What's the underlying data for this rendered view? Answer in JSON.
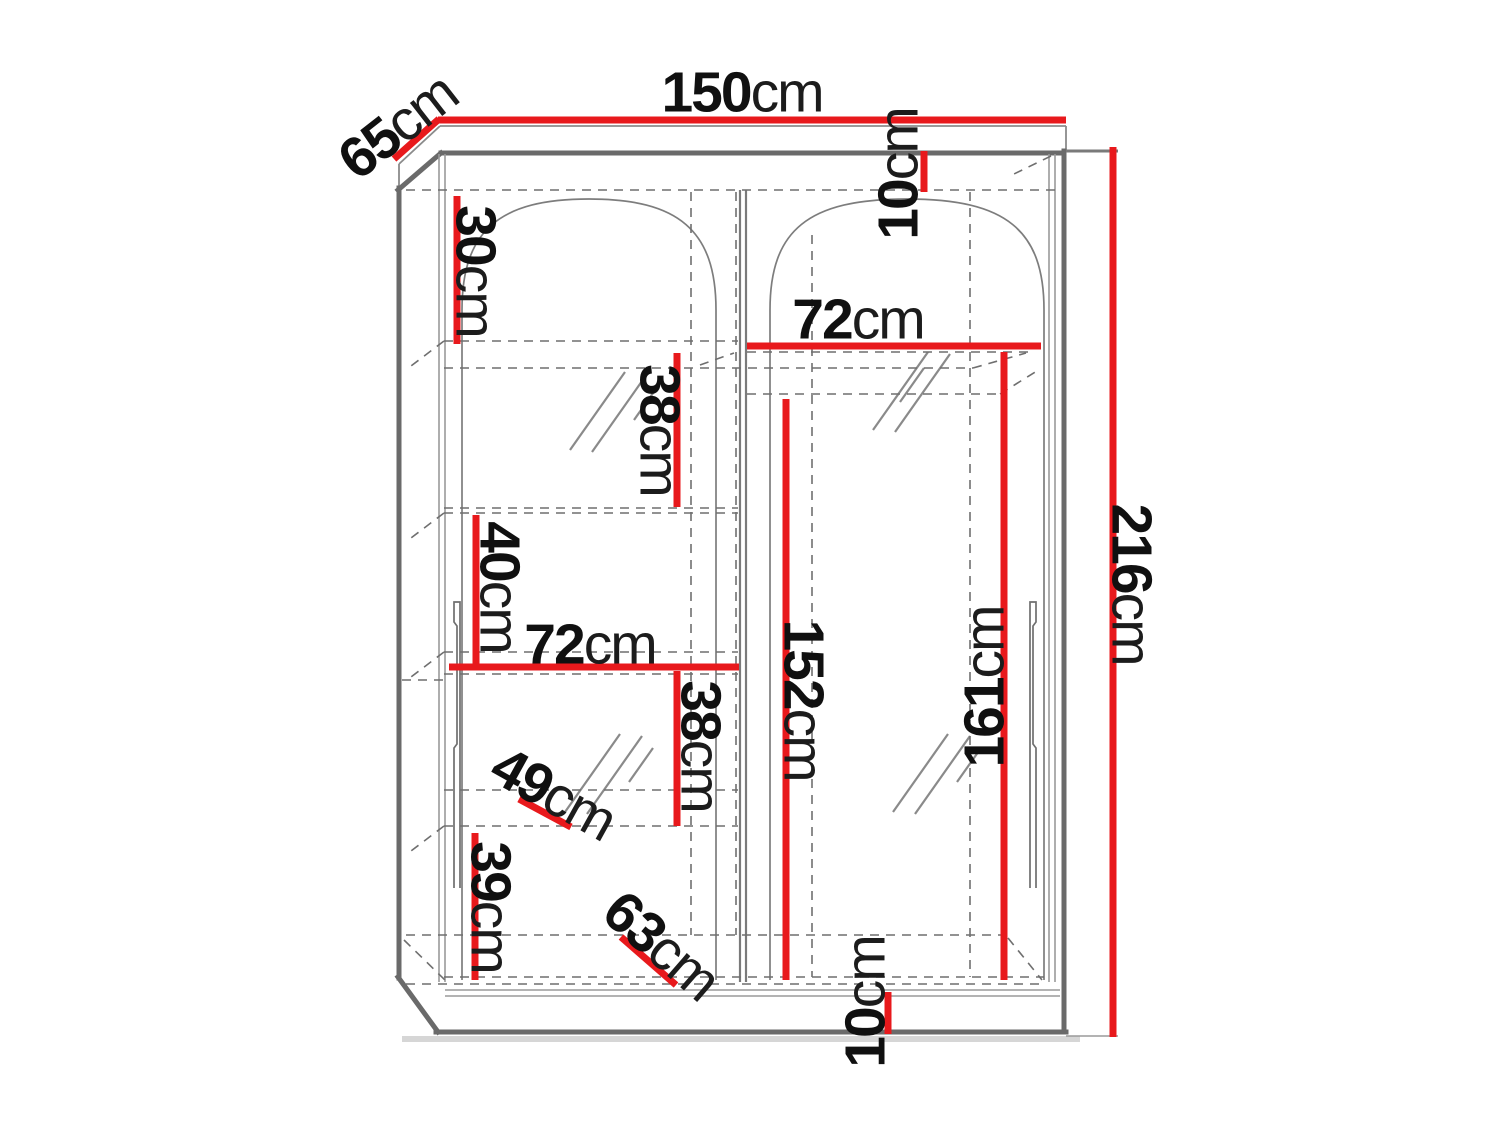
{
  "diagram": {
    "kind": "wardrobe dimension drawing",
    "colors": {
      "dimension_red": "#e8191c",
      "structure_dark": "#6a6a6a",
      "structure_light": "#9a9a9a",
      "dashed_gray": "#6f6f6f",
      "text": "#101010"
    }
  },
  "dimensions": {
    "width": {
      "value": "150",
      "unit": "cm"
    },
    "depth": {
      "value": "65",
      "unit": "cm"
    },
    "height": {
      "value": "216",
      "unit": "cm"
    },
    "top_shelf_height": {
      "value": "10",
      "unit": "cm"
    },
    "right_compartment_width": {
      "value": "72",
      "unit": "cm"
    },
    "left_top_compartment_height": {
      "value": "30",
      "unit": "cm"
    },
    "left_upper_shelf_spacing": {
      "value": "38",
      "unit": "cm"
    },
    "left_middle_shelf_spacing": {
      "value": "40",
      "unit": "cm"
    },
    "left_compartment_width": {
      "value": "72",
      "unit": "cm"
    },
    "left_lower_shelf_spacing": {
      "value": "38",
      "unit": "cm"
    },
    "left_shelf_depth": {
      "value": "49",
      "unit": "cm"
    },
    "left_bottom_compartment_height": {
      "value": "39",
      "unit": "cm"
    },
    "bottom_shelf_depth": {
      "value": "63",
      "unit": "cm"
    },
    "right_hanging_height_front": {
      "value": "152",
      "unit": "cm"
    },
    "right_hanging_height_back": {
      "value": "161",
      "unit": "cm"
    },
    "plinth_height": {
      "value": "10",
      "unit": "cm"
    }
  }
}
